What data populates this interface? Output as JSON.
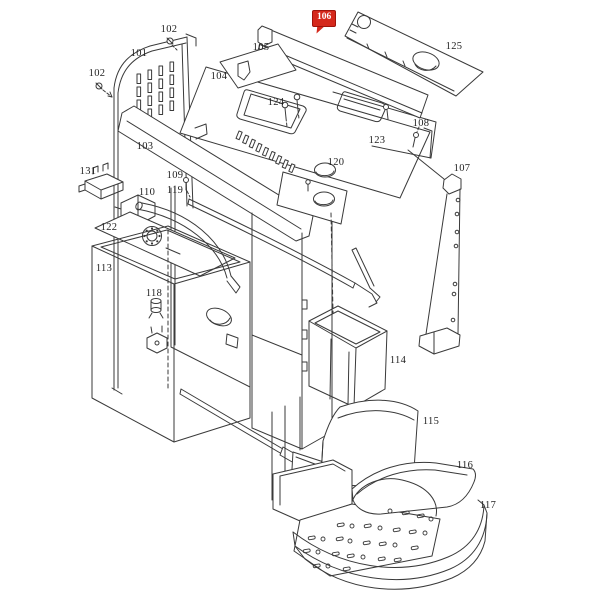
{
  "canvas": {
    "background": "#ffffff",
    "stroke_color": "#3a3a3a",
    "label_color": "#1f1f1f"
  },
  "highlight": {
    "label": "106",
    "background": "#d5281b",
    "text_color": "#ffffff",
    "border": "#9e130a"
  },
  "labels": [
    {
      "text": "101"
    },
    {
      "text": "102"
    },
    {
      "text": "102"
    },
    {
      "text": "103"
    },
    {
      "text": "104"
    },
    {
      "text": "105"
    },
    {
      "text": "106"
    },
    {
      "text": "107"
    },
    {
      "text": "108"
    },
    {
      "text": "109"
    },
    {
      "text": "110"
    },
    {
      "text": "113"
    },
    {
      "text": "114"
    },
    {
      "text": "115"
    },
    {
      "text": "116"
    },
    {
      "text": "117"
    },
    {
      "text": "118"
    },
    {
      "text": "119"
    },
    {
      "text": "120"
    },
    {
      "text": "122"
    },
    {
      "text": "123"
    },
    {
      "text": "124"
    },
    {
      "text": "125"
    },
    {
      "text": "131"
    }
  ]
}
